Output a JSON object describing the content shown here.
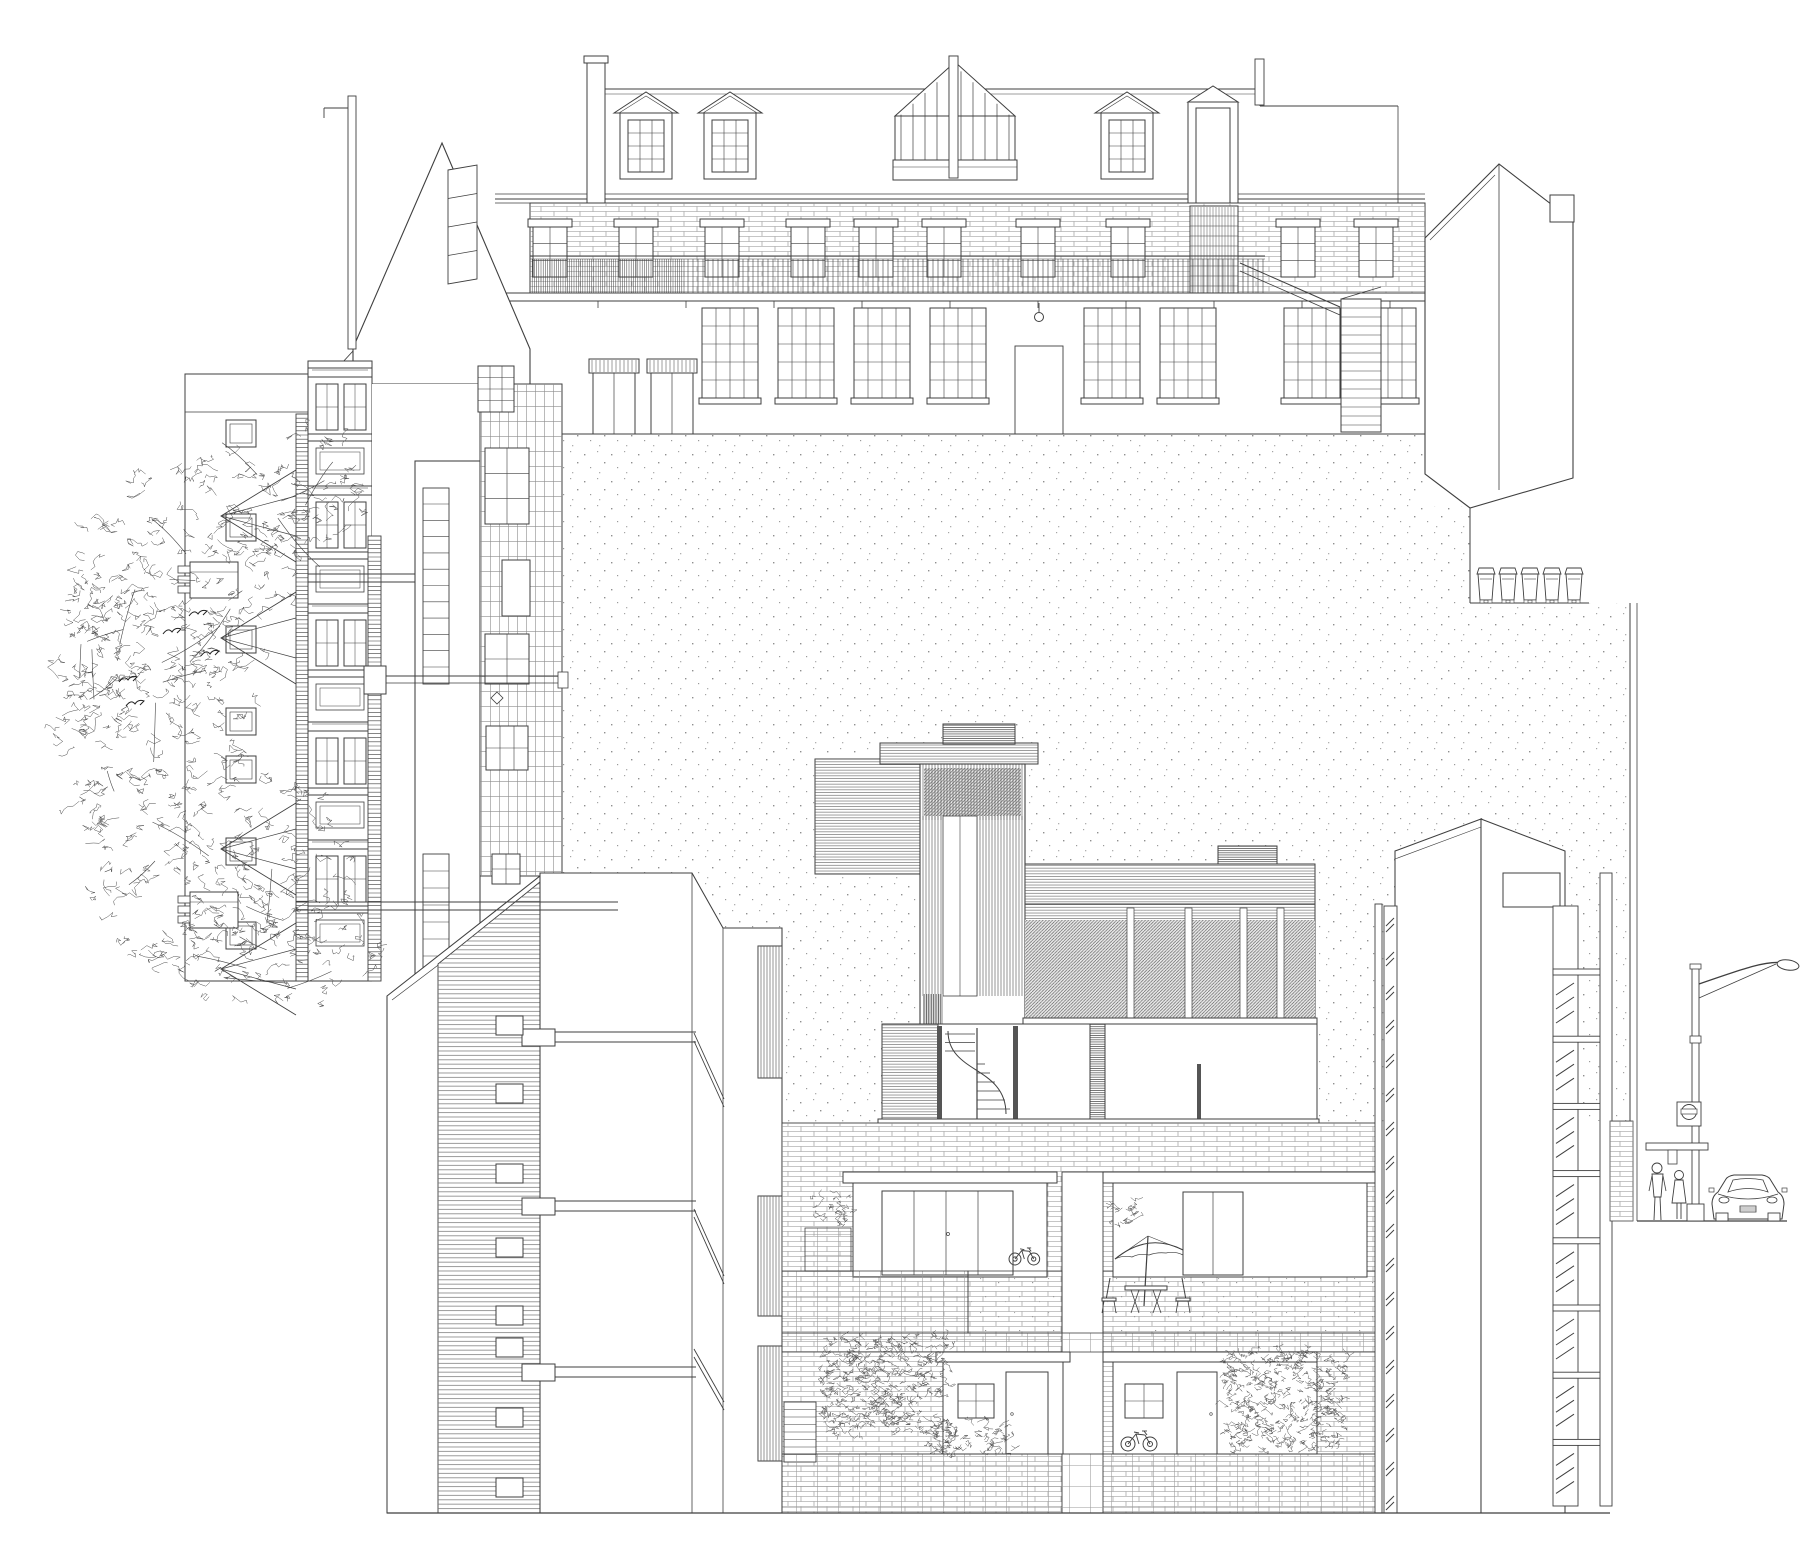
{
  "document": {
    "title": "Rear courtyard elevation — architectural line drawing",
    "type": "architectural-elevation",
    "paper": "#ffffff"
  },
  "colors": {
    "ink": "#3f3f3f",
    "light": "#8d8d8d",
    "hatch": "#555555",
    "dot": "#8f8f8f"
  },
  "scene": {
    "courtyard_wall": {
      "label": "Stippled party wall enclosing the courtyard"
    },
    "mews_terrace": {
      "label": "Rear terrace with mansard roof and balcony walkway",
      "dormers": 3,
      "glazed_gable": 1,
      "door_dormer": 1,
      "chimneys": 3,
      "brick_band_windows": 10,
      "ground_windows": 8,
      "doors": 2,
      "has_fire_escape": true
    },
    "annex": {
      "label": "Gabled annex with slanted rooflight"
    },
    "right_gabled_building": {
      "label": "Gabled corner building"
    },
    "bins": {
      "label": "Wheelie bins on boundary wall",
      "count": 5
    },
    "left_terrace": {
      "label": "Victorian terrace seen in side elevation",
      "gables": 4,
      "square_windows": 7,
      "bay_modules": 5,
      "chimneys": 2
    },
    "tree": {
      "label": "Street tree with birds",
      "birds": 5
    },
    "rear_wing": {
      "label": "Rear closet wing with stair windows and brick face"
    },
    "flank_building": {
      "label": "Sectioned flank wall with floor slabs",
      "small_windows": 8,
      "floor_slabs": 3
    },
    "modern_house": {
      "label": "Infill house with slatted tower and glazed wing",
      "has_spiral_stair": true
    },
    "courtyard_flats": {
      "label": "Courtyard flats with recessed balconies",
      "upper_balconies": 2,
      "lower_units": 2,
      "bikes": 2,
      "has_umbrella": true,
      "has_table_and_chairs": true,
      "planters": 4
    },
    "right_tower": {
      "label": "Balcony access tower",
      "balconies": 8
    },
    "street": {
      "label": "Street scene",
      "people": 2,
      "cars": 1,
      "has_lamp_post": true,
      "has_sign": true,
      "has_bench": true
    }
  }
}
